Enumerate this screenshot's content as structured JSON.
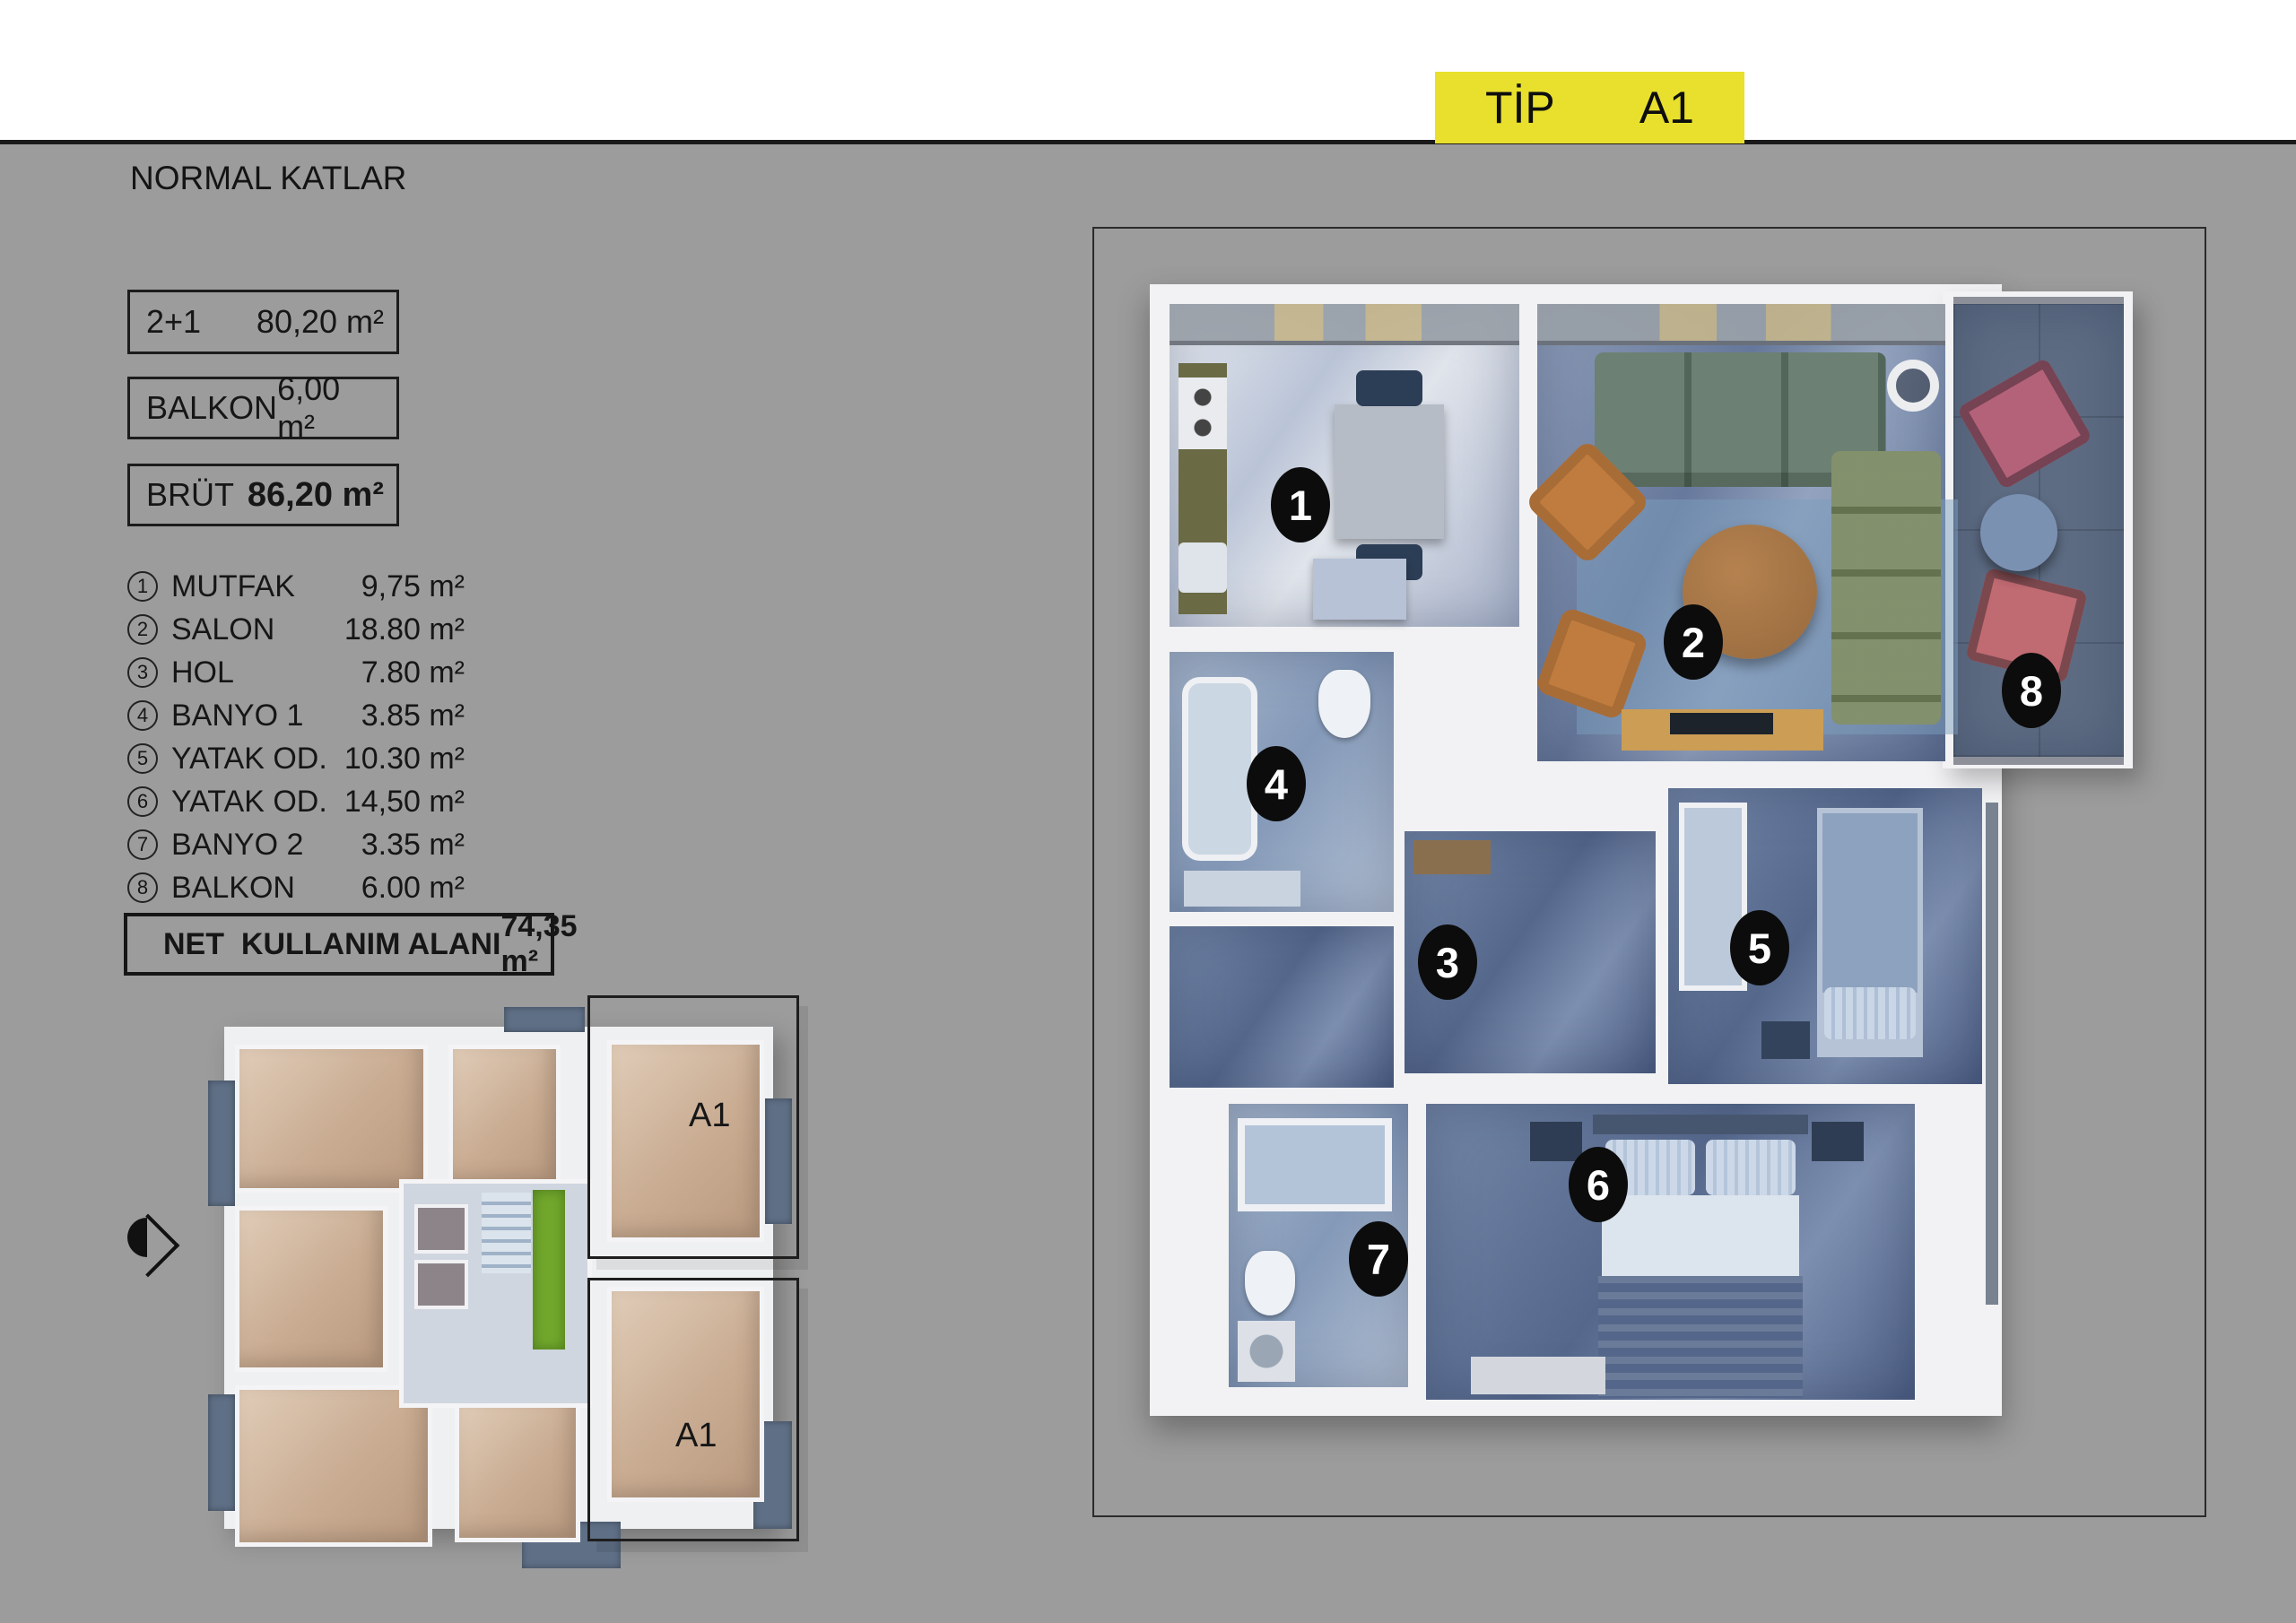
{
  "colors": {
    "background": "#9c9c9c",
    "accent_yellow": "#e8e02c",
    "ink": "#161616"
  },
  "header": {
    "title": "A1 BLOK",
    "subtitle": "NORMAL KATLAR",
    "badge": {
      "label": "TİP",
      "value": "A1"
    }
  },
  "summary_boxes": [
    {
      "label": "2+1",
      "value": "80,20 m²"
    },
    {
      "label": "BALKON",
      "value": "6,00 m²"
    },
    {
      "label": "BRÜT",
      "value": "86,20 m²"
    }
  ],
  "room_list": [
    {
      "no": "1",
      "name": "MUTFAK",
      "area": "9,75 m²"
    },
    {
      "no": "2",
      "name": "SALON",
      "area": "18.80 m²"
    },
    {
      "no": "3",
      "name": "HOL",
      "area": "7.80 m²"
    },
    {
      "no": "4",
      "name": "BANYO 1",
      "area": "3.85 m²"
    },
    {
      "no": "5",
      "name": "YATAK OD.",
      "area": "10.30 m²"
    },
    {
      "no": "6",
      "name": "YATAK OD.",
      "area": "14,50 m²"
    },
    {
      "no": "7",
      "name": "BANYO 2",
      "area": "3.35 m²"
    },
    {
      "no": "8",
      "name": "BALKON",
      "area": "6.00 m²"
    }
  ],
  "net_box": {
    "label": "NET  KULLANIM ALANI",
    "value": "74,35 m²"
  },
  "key_plan": {
    "top_label": "A1",
    "bottom_label": "A1"
  },
  "markers": {
    "m1": "1",
    "m2": "2",
    "m3": "3",
    "m4": "4",
    "m5": "5",
    "m6": "6",
    "m7": "7",
    "m8": "8"
  }
}
